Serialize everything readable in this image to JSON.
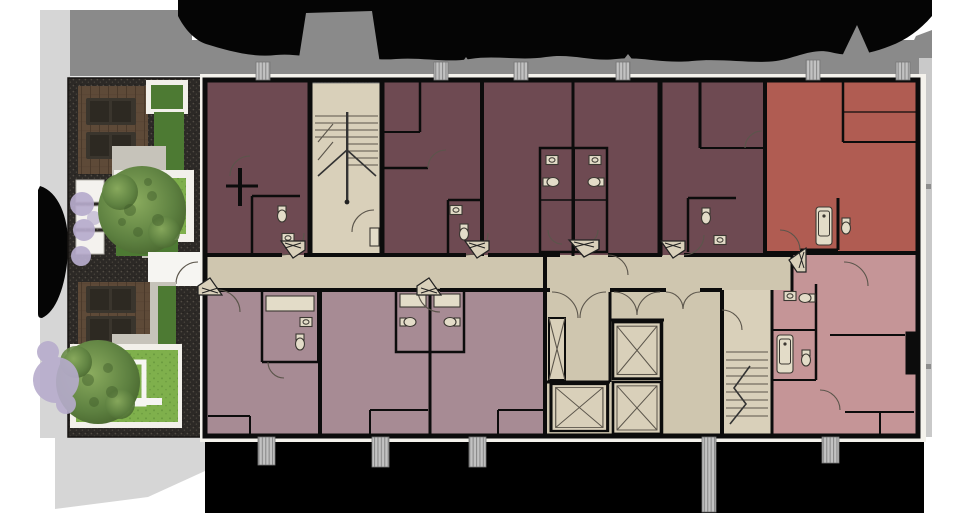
{
  "scene": {
    "kind": "architectural-floor-plan-render",
    "subject": "residential floor plan with landscaped courtyard, street tree band above and shadow band below"
  },
  "palette": {
    "page_white": "#ffffff",
    "street_gray": "#8a8a8a",
    "sidewalk_gray": "#d6d6d6",
    "edge_gray": "#c9c9c9",
    "canopy_black": "#050505",
    "shadow_black": "#000000",
    "gravel_dark": "#2c2926",
    "gravel_speck": "#514c44",
    "deck_brown": "#5e4a38",
    "deck_line": "#4b3a2b",
    "lounge_dark": "#3a352d",
    "lawn_green": "#7fb04c",
    "lawn_speck": "#6a9a3e",
    "hedge_green": "#4d7a33",
    "tree_green_light": "#8aab5e",
    "tree_green_dark": "#5d8040",
    "tree_lavender": "#b7accd",
    "path_gray": "#c6c3ba",
    "corridor_beige": "#cfc6af",
    "stair_beige": "#d9d0ba",
    "unit_dark_maroon": "#6e4a52",
    "unit_terracotta": "#b05c52",
    "unit_mauve": "#a78b94",
    "unit_pink": "#c59597",
    "wall_black": "#0c0c0c",
    "line_thin": "#5b554b",
    "fixture_line": "#3c3832",
    "fixture_fill": "#e3dcc8",
    "downspout_gray": "#c2c2c2",
    "downspout_line": "#8b8b8b"
  },
  "inventory": {
    "units_north_dark_maroon": 5,
    "units_northeast_terracotta": 1,
    "units_south_mauve": 3,
    "units_southeast_pink": 1,
    "elevators": 3,
    "stairwells": 2,
    "courtyard_large_trees": 2,
    "lavender_trees": 4,
    "deck_loungers": 4,
    "white_planters": 3,
    "unit_entry_markers": 7,
    "downspouts_top": 6,
    "downspouts_bottom": 5
  }
}
